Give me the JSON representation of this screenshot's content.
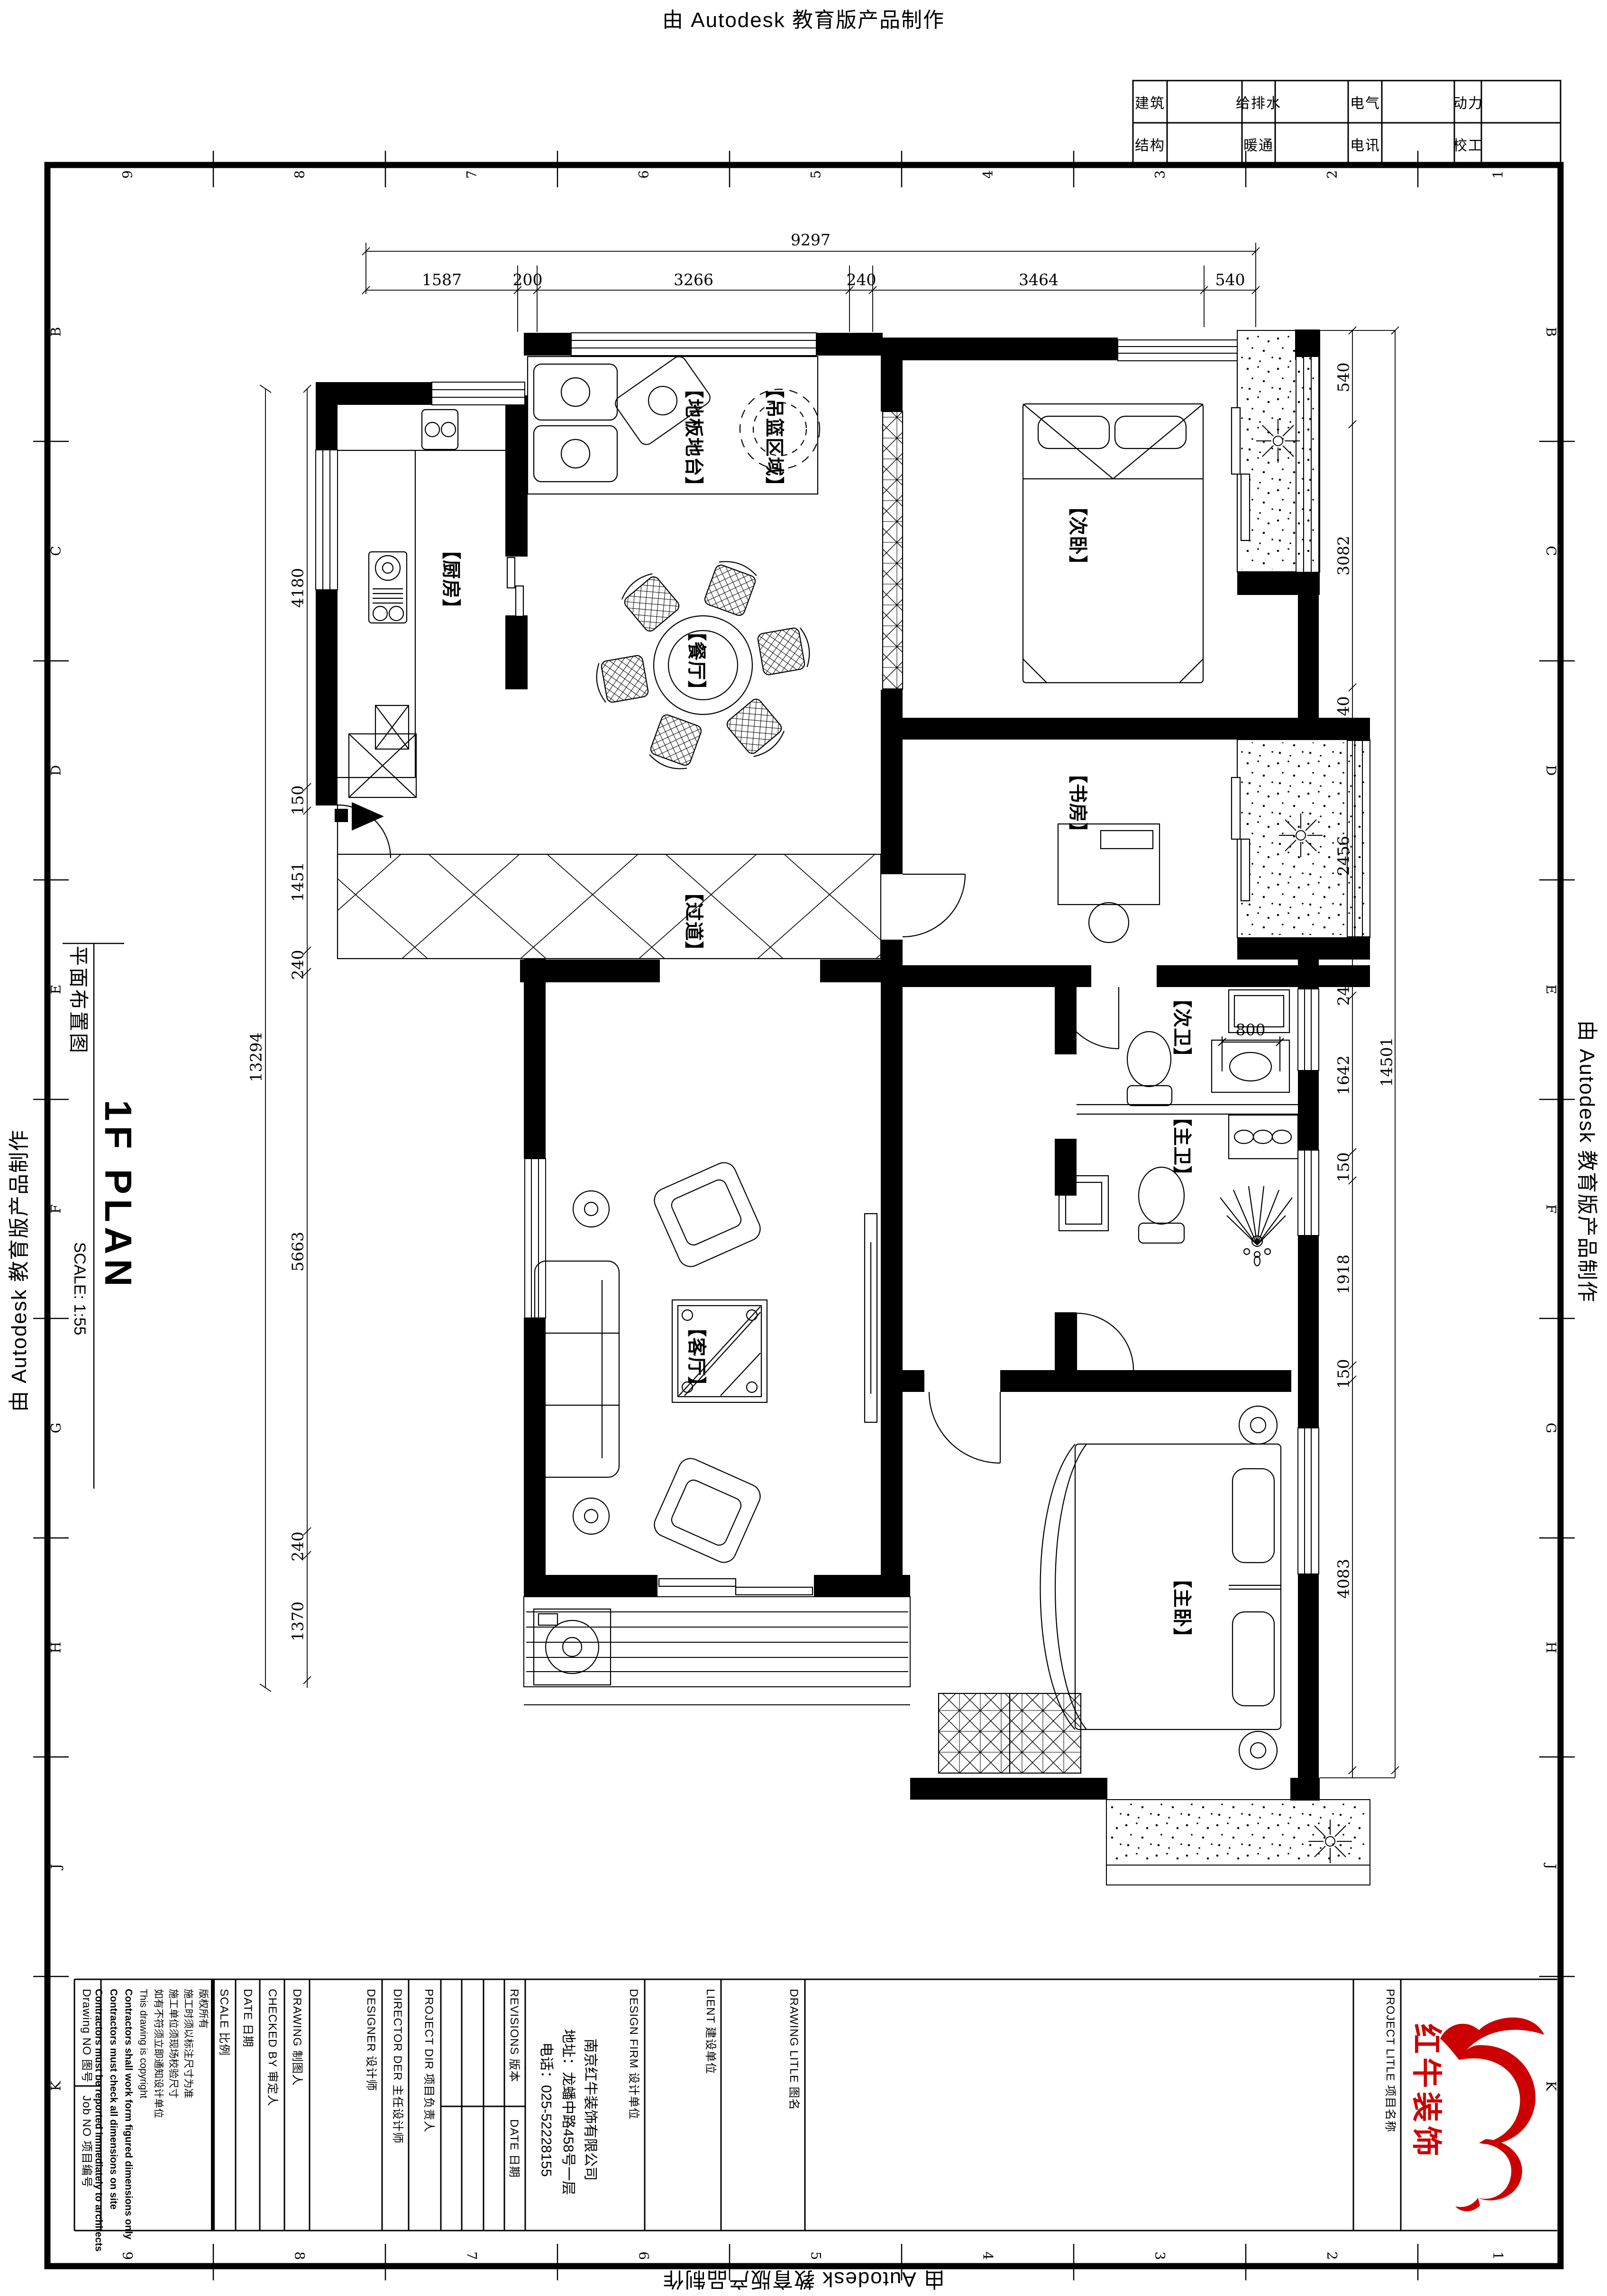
{
  "watermark": {
    "text": "由 Autodesk 教育版产品制作"
  },
  "stamp": {
    "r1": [
      "建筑",
      "给排水",
      "电气",
      "动力"
    ],
    "r2": [
      "结构",
      "暖通",
      "电讯",
      "校工"
    ]
  },
  "grid": {
    "cols": [
      "9",
      "8",
      "7",
      "6",
      "5",
      "4",
      "3",
      "2",
      "1"
    ],
    "rows": [
      "B",
      "C",
      "D",
      "E",
      "F",
      "G",
      "H",
      "J",
      "K"
    ]
  },
  "titlepanel": {
    "cn": "平面布置图",
    "en": "1F PLAN",
    "scale": "SCALE: 1:55"
  },
  "rooms": {
    "hanging": "【吊篮区域】",
    "platform": "【地板地台】",
    "kitchen": "【厨房】",
    "dining": "【餐厅】",
    "bed2": "【次卧】",
    "study": "【书房】",
    "hall": "【过道】",
    "bath2": "【次卫】",
    "bath1": "【主卫】",
    "living": "【客厅】",
    "bed1": "【主卧】"
  },
  "dims": {
    "top_total": "9297",
    "top": [
      "1587",
      "200",
      "3266",
      "240",
      "3464",
      "540"
    ],
    "left_total": "13294",
    "left": [
      "4180",
      "150",
      "1451",
      "240",
      "5663",
      "240",
      "1370"
    ],
    "right_total": "14501",
    "right": [
      "540",
      "3082",
      "240",
      "2456",
      "240",
      "1642",
      "150",
      "1918",
      "150",
      "4083"
    ],
    "inner_800": "800"
  },
  "tb": {
    "drawing_no": "Drawing NO 图号",
    "job_no": "Job NO 项目编号",
    "copyright": [
      "版权所有",
      "施工时须以标注尺寸为准",
      "施工单位须现场校验尺寸",
      "如有不符须立即通知设计单位",
      "This drawing is copyright",
      "Contractors shall work form figured dimensions only",
      "Contractors must check all dimensions on site",
      "Contractors must be reported immediately to architects"
    ],
    "scale": "SCALE 比例",
    "date": "DATE 日期",
    "checked": "CHECKED BY 审定人",
    "drawing": "DRAWING 制图人",
    "designer": "DESIGNER 设计师",
    "director": "DIRECTOR DER 主任设计师",
    "project_dir": "PROJECT DIR 项目负责人",
    "revisions": "REVISIONS 版本",
    "rev_date": "DATE 日期",
    "design_firm": "DESIGN FIRM 设计单位",
    "company": [
      "南京红牛装饰有限公司",
      "地址：龙蟠中路458号一层",
      "电话：025-52228155"
    ],
    "client": "LIENT 建设单位",
    "drawing_title": "DRAWING LITLE 图名",
    "project_title": "PROJECT LITLE 项目名称"
  },
  "logo": {
    "name": "红牛装饰",
    "color": "#cc0000"
  }
}
